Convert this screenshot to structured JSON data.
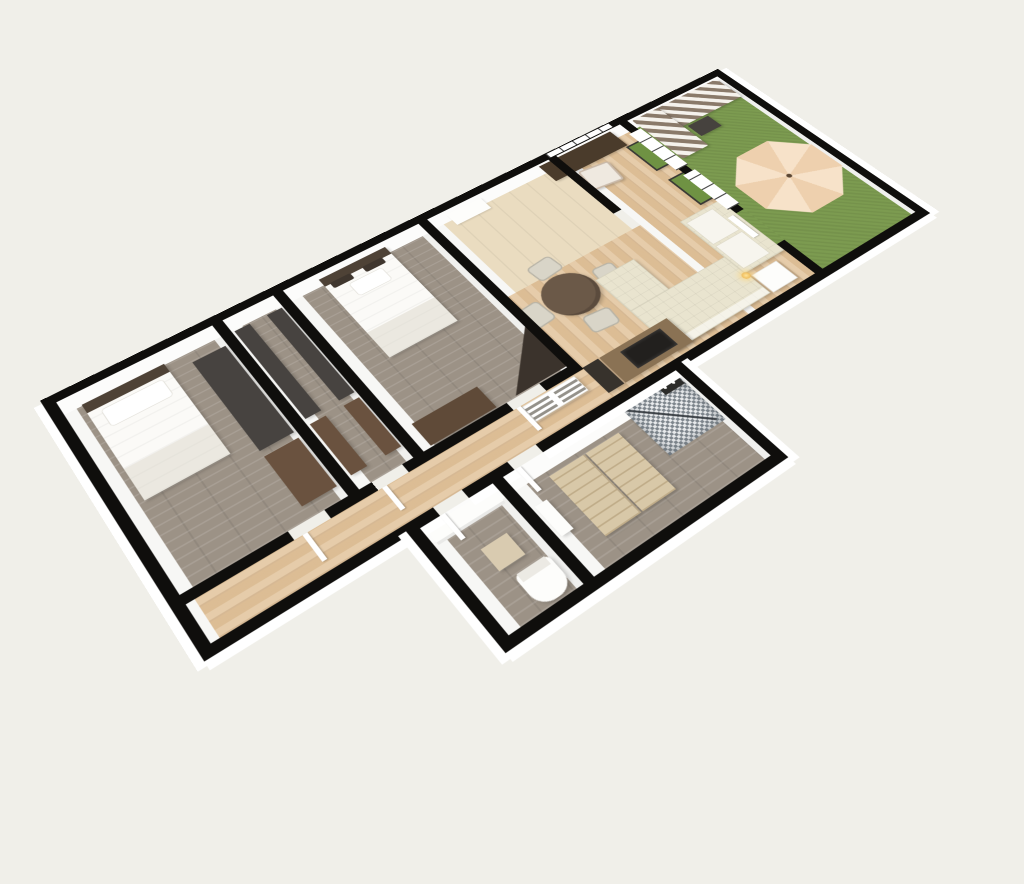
{
  "scene": {
    "kind": "3d-floor-plan-render",
    "description": "Perspective 3D top view of a furnished apartment floor plan rotated diagonally on a light background",
    "text_visible": "none"
  },
  "colors": {
    "canvas_bg": "#f0efe9",
    "wall": "#0f0e0c",
    "wall_face": "#ffffff",
    "wood_floor": "#e2c59e",
    "carpet_floor": "#9c9286",
    "entry_floor": "#eadcc0",
    "grass": "#7c9b50",
    "umbrella_light": "#f7e2c9",
    "umbrella_dark": "#eed0ae",
    "sofa_cream": "#e9e4cf",
    "dark_furniture": "#474340",
    "brown_furniture": "#6a523f",
    "wood_cabinet": "#8a7254",
    "tv_black": "#22201e",
    "stripe_dark": "#8a7a6a",
    "stripe_light": "#f5f2ec",
    "chair_beige": "#d9d5c8",
    "table_brown": "#6b5948",
    "bed_white": "#fbfaf7",
    "headboard": "#4e4236"
  },
  "rooms": [
    {
      "id": "bedroom-1",
      "label": "Bedroom 1",
      "floor": "gray wood planks",
      "furniture": [
        "double bed",
        "tall wardrobe",
        "dresser"
      ]
    },
    {
      "id": "walk-in-closet",
      "label": "Walk-in closet",
      "floor": "gray wood planks",
      "furniture": [
        "wardrobe left",
        "dresser left",
        "wardrobe right",
        "dresser right"
      ]
    },
    {
      "id": "bedroom-2",
      "label": "Bedroom 2",
      "floor": "gray wood planks",
      "furniture": [
        "double bed",
        "dresser",
        "corner desk"
      ]
    },
    {
      "id": "hallway",
      "label": "Hallway",
      "floor": "light wood planks",
      "furniture": [
        "slatted cabinet"
      ]
    },
    {
      "id": "entry-hall",
      "label": "Entry hall",
      "floor": "beige tile",
      "furniture": [
        "doormat"
      ]
    },
    {
      "id": "living-room",
      "label": "Living / dining room",
      "floor": "light wood planks",
      "furniture": [
        "round dining table",
        "dining chair x4",
        "desk",
        "desk chair",
        "corner sofa",
        "loveseat",
        "side table",
        "candle",
        "media cabinet",
        "tv sideboard",
        "tv",
        "planter 1",
        "planter 2"
      ]
    },
    {
      "id": "bathroom",
      "label": "Bathroom",
      "floor": "gray wood planks",
      "furniture": [
        "mosaic shower",
        "glass screen",
        "dresser 1",
        "dresser 2",
        "wall shelf",
        "water heater"
      ]
    },
    {
      "id": "wc",
      "label": "WC",
      "floor": "gray wood planks",
      "furniture": [
        "washbasin counter",
        "base cabinet",
        "toilet"
      ]
    },
    {
      "id": "balcony",
      "label": "Balcony",
      "floor": "artificial grass",
      "furniture": [
        "striped lounge sofa",
        "coffee table",
        "parasol"
      ]
    }
  ]
}
